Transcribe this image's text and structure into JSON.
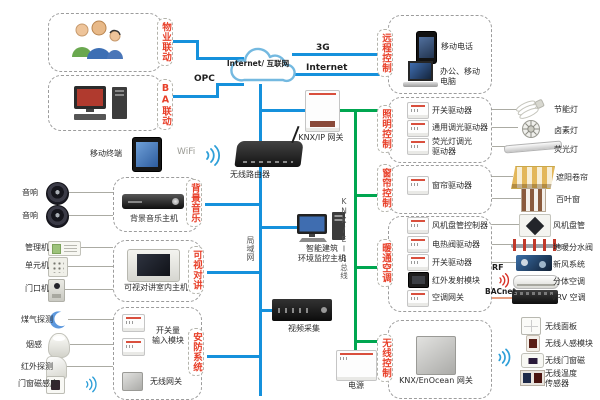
{
  "colors": {
    "blue": "#1591dc",
    "green": "#00a650",
    "red": "#e8402a"
  },
  "left": {
    "property_label": "物业联动",
    "ba_label": "BA联动",
    "opc": "OPC",
    "mobile_terminal": "移动终端",
    "wifi": "WiFi",
    "speaker_top": "音响",
    "speaker_bottom": "音响",
    "bgm_tab": "背景音乐",
    "bgm_host": "背景音乐主机",
    "mgmt": "管理机",
    "unit": "单元机",
    "doorphone": "门口机",
    "intercom_tab": "可视对讲",
    "intercom_host": "可视对讲室内主机",
    "gas": "煤气探测",
    "smoke": "烟感",
    "infrared": "红外探测",
    "door_magnet": "门窗磁感应",
    "security_tab": "安防系统",
    "switch_input": "开关量\n输入模块",
    "wireless_gateway": "无线网关"
  },
  "center": {
    "cloud": "Internet/ 互联网",
    "line_3g": "3G",
    "line_internet": "Internet",
    "knx_ip_gateway": "KNX/IP 网关",
    "router": "无线路由器",
    "lan": "局域网",
    "knx_bus": "KNX/EIB总线",
    "host": "智能建筑\n环境监控主机",
    "video": "视频采集",
    "power": "电源"
  },
  "right": {
    "remote": {
      "tab": "远程控制",
      "phone": "移动电话",
      "computer": "办公、移动\n电脑"
    },
    "lighting": {
      "tab": "照明控制",
      "drivers": [
        "开关驱动器",
        "通用调光驱动器",
        "荧光灯调光\n驱动器"
      ],
      "devices": [
        "节能灯",
        "卤素灯",
        "荧光灯"
      ]
    },
    "curtain": {
      "tab": "窗帘控制",
      "driver": "窗帘驱动器",
      "devices": [
        "遮阳卷帘",
        "百叶窗"
      ]
    },
    "hvac": {
      "tab": "暖通空调",
      "drivers": [
        "风机盘管控制器",
        "电热阀驱动器",
        "开关驱动器",
        "红外发射模块",
        "空调网关"
      ],
      "devices": [
        "风机盘管",
        "地暖分水阀",
        "新风系统",
        "分体空调",
        "VRV 空调"
      ],
      "rf": "RF",
      "bacnet": "BACnet"
    },
    "wireless": {
      "tab": "无线控制",
      "gateway": "KNX/EnOcean 网关",
      "devices": [
        "无线面板",
        "无线人感模块",
        "无线门窗磁",
        "无线温度\n传感器"
      ]
    }
  }
}
